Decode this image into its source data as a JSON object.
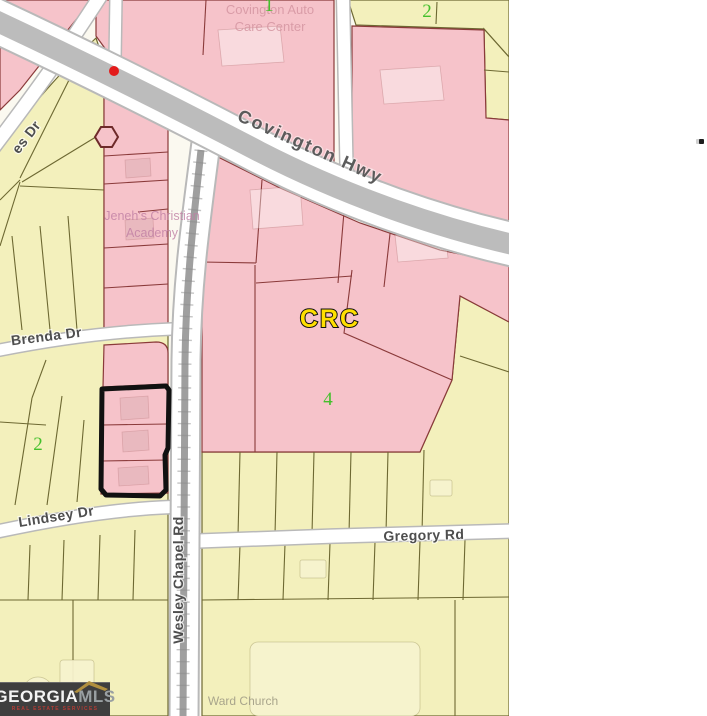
{
  "colors": {
    "parcel_pink": "#f6c3ca",
    "parcel_pink_border": "#8a3a3a",
    "parcel_yellow": "#f3f0bc",
    "parcel_yellow_border": "#6d6832",
    "highway_gray": "#bcbcbc",
    "road_white": "#ffffff",
    "road_casing": "#b9b9b9",
    "railroad_gray": "#9f9f9f",
    "subject_outline": "#111111",
    "zone_number_green": "#44c02c",
    "crc_yellow": "#ffdf00",
    "marker_red": "#e31b1b",
    "road_label": "#4e4e4e",
    "place_label_pink": "#d596a2",
    "place_label_purple": "#c07fa4",
    "place_label_olive": "#a5a189"
  },
  "map": {
    "roads": {
      "covington_hwy": "Covington Hwy",
      "wesley_chapel_rd": "Wesley Chapel Rd",
      "gregory_rd": "Gregory Rd",
      "lindsey_dr": "Lindsey Dr",
      "brenda_dr": "Brenda Dr",
      "es_dr": "es Dr"
    },
    "places": {
      "covington_auto_line1": "Covington Auto",
      "covington_auto_line2": "Care Center",
      "jenehs_line1": "Jeneh's Christian",
      "jenehs_line2": "Academy",
      "ward_church": "Ward Church"
    },
    "zones": {
      "crc": "CRC",
      "zone1": "1",
      "zone2_top": "2",
      "zone2_left": "2",
      "zone4": "4"
    }
  },
  "logo": {
    "brand": "GEORGIA",
    "suffix": "MLS",
    "tagline": "REAL ESTATE SERVICES"
  }
}
